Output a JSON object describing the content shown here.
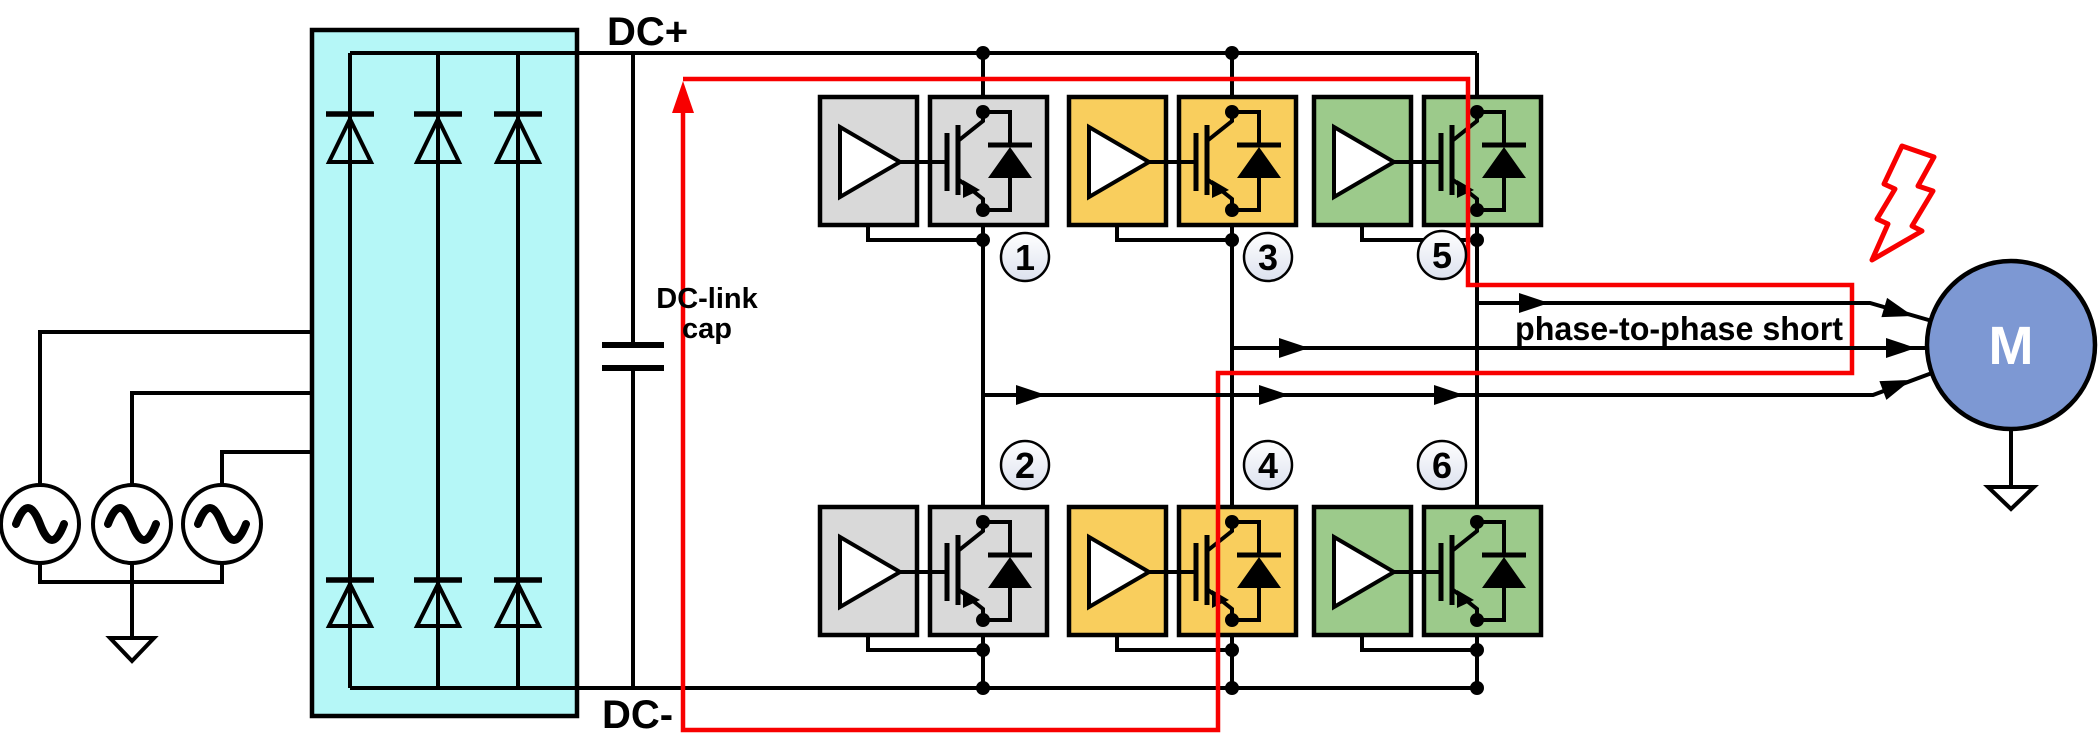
{
  "labels": {
    "dc_plus": "DC+",
    "dc_minus": "DC-",
    "dc_link_cap_line1": "DC-link",
    "dc_link_cap_line2": "cap",
    "fault_label": "phase-to-phase short",
    "motor_label": "M"
  },
  "modules": [
    {
      "number": "1",
      "color_name": "gray",
      "fill": "#D9D9D9"
    },
    {
      "number": "2",
      "color_name": "gray",
      "fill": "#D9D9D9"
    },
    {
      "number": "3",
      "color_name": "yellow",
      "fill": "#F9CE5D"
    },
    {
      "number": "4",
      "color_name": "yellow",
      "fill": "#F9CE5D"
    },
    {
      "number": "5",
      "color_name": "green",
      "fill": "#9CCA8B"
    },
    {
      "number": "6",
      "color_name": "green",
      "fill": "#9CCA8B"
    }
  ],
  "colors": {
    "rectifier_fill": "#B5F7F7",
    "motor_fill": "#7D98D3",
    "fault_red": "#F80000",
    "line_black": "#000000",
    "badge_fill_top": "#FFFFFF",
    "badge_fill_bottom": "#DCE1EE"
  },
  "components": {
    "ac_source_count": 3,
    "rectifier_diode_count": 6,
    "igbt_module_count": 6
  }
}
